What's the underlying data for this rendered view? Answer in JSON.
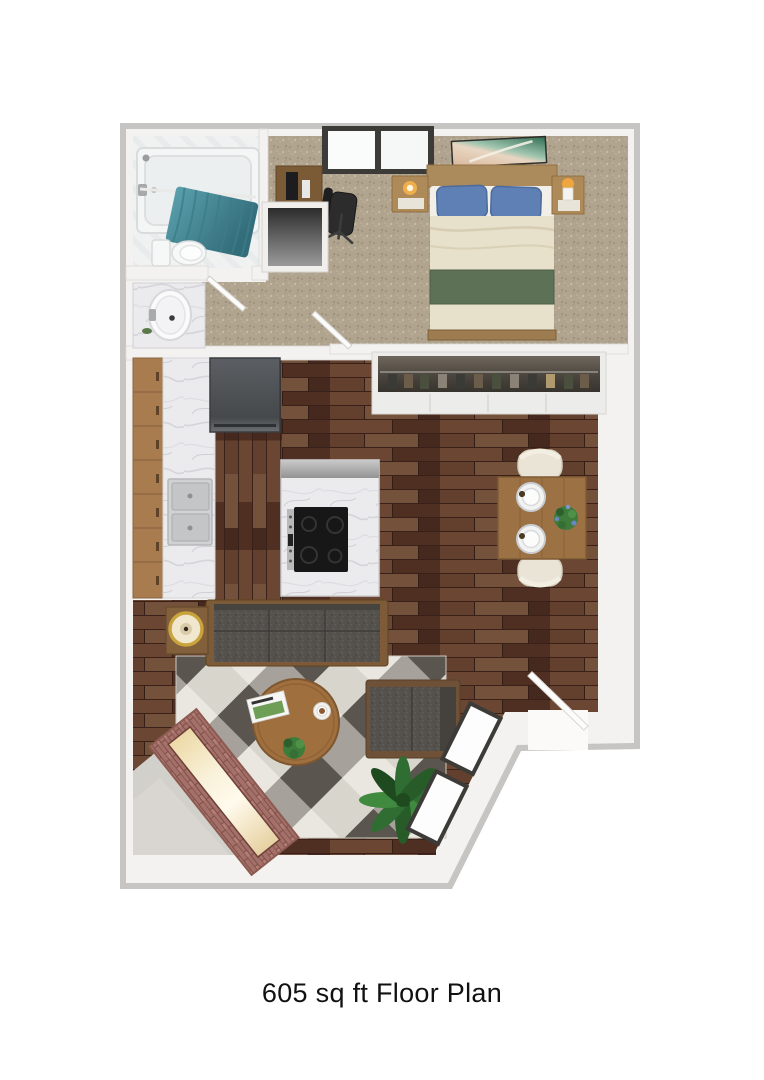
{
  "image": {
    "type": "floor-plan-render",
    "caption": "605 sq ft Floor Plan"
  },
  "palette": {
    "wall_gray": "#c6c5c3",
    "wall_face": "#f3f2f0",
    "carpet": "#b1a48f",
    "hardwood": "#5d3c29",
    "marble": "#ebebed",
    "cabinet_wood": "#a97c4f",
    "teal_curtain": "#4d8a97",
    "pillow_blue": "#5e80b4",
    "blanket_cream": "#e7e0cb",
    "runner_green": "#5d7157",
    "sofa_gray": "#55524e",
    "rug_cream": "#eae7e0",
    "rug_charcoal": "#5a554e",
    "brick_red": "#a4706a",
    "fire_glow": "#f9f1da",
    "plant_green": "#2f6d33",
    "concrete_gray": "#d2d0cb",
    "lamp_gold": "#c9a33c",
    "table_wood": "#9c7144",
    "chair_cream": "#e9e4d6",
    "window_frame": "#3d3b38",
    "caption_color": "#111111"
  }
}
